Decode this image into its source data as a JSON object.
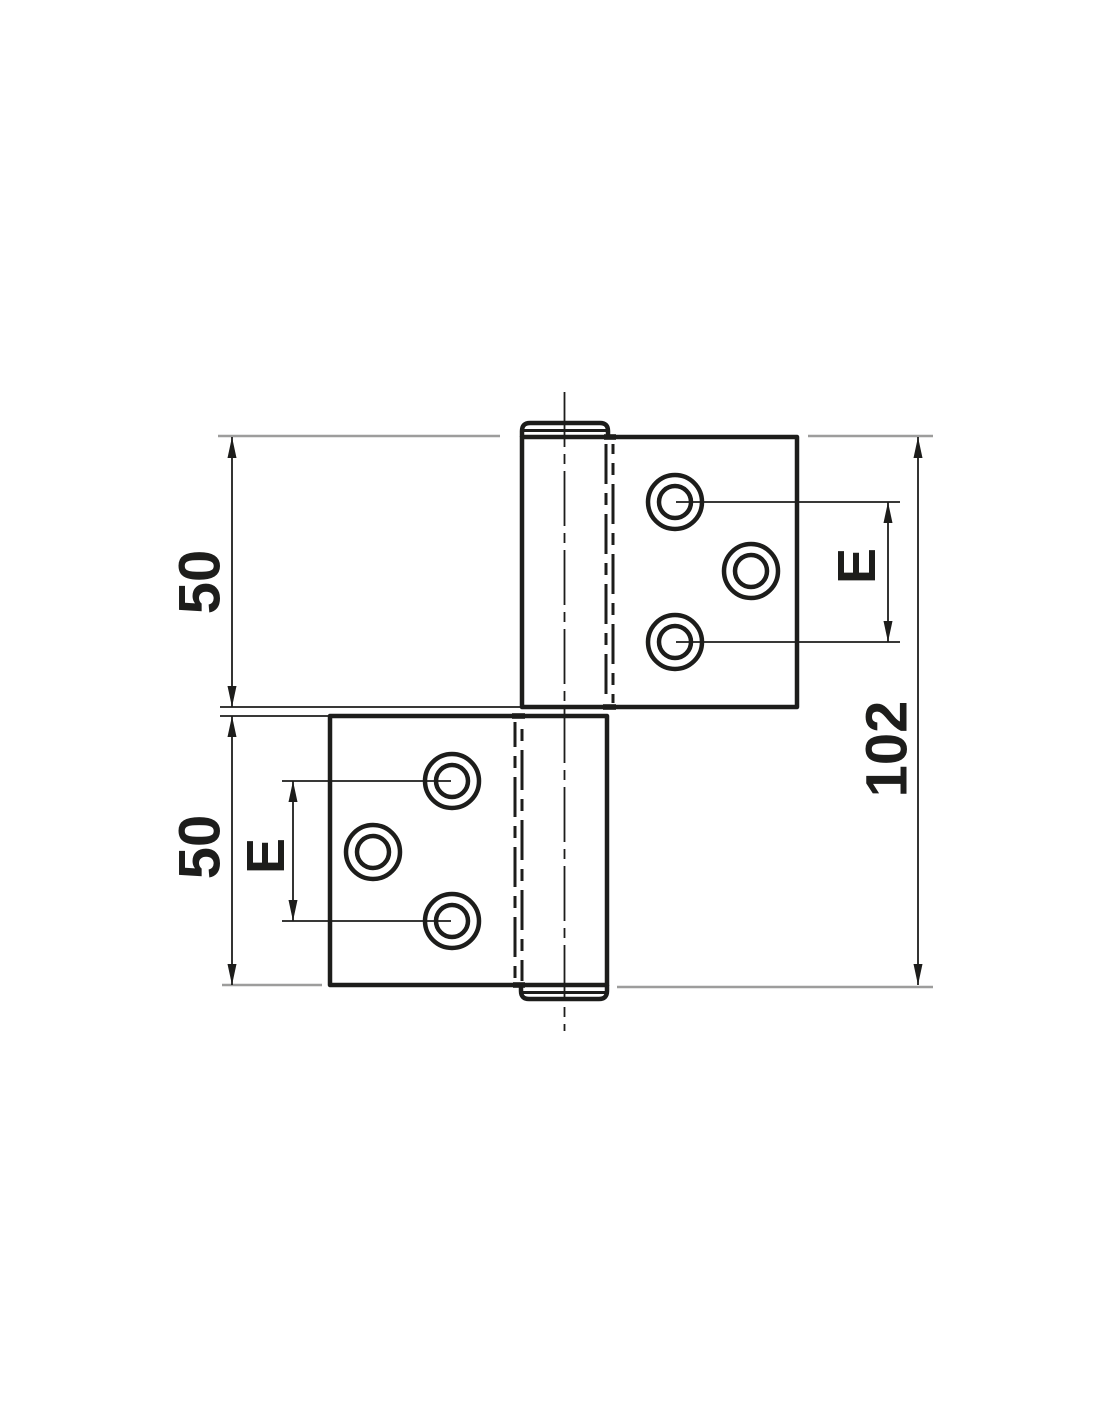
{
  "drawing": {
    "labels": {
      "upper_leaf_height": "50",
      "lower_leaf_height": "50",
      "overall_height": "102",
      "upper_hole_spacing": "E",
      "lower_hole_spacing": "E"
    },
    "colors": {
      "outline": "#1d1d1b",
      "extension_line": "#9d9d9c",
      "background": "#ffffff"
    }
  }
}
